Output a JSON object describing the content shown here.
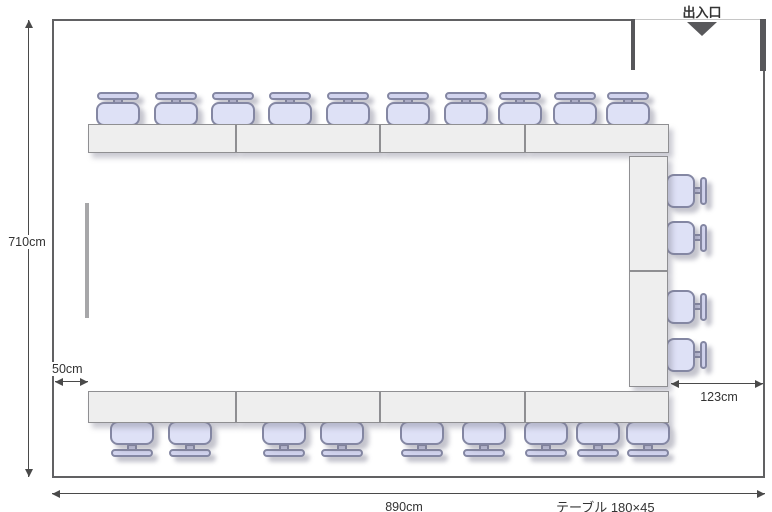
{
  "labels": {
    "entrance": "出入口",
    "room_height": "710cm",
    "room_width": "890cm",
    "left_gap": "50cm",
    "right_gap": "123cm",
    "table_spec": "テーブル 180×45"
  },
  "colors": {
    "wall": "#616163",
    "door_open_line": "#c6c6c6",
    "entrance_marker": "#58585b",
    "table_fill": "#eeeeee",
    "table_border": "#8f8f92",
    "chair_fill": "#dee1f6",
    "chair_back_fill": "#d2d4ee",
    "chair_border": "#8487a3",
    "dimension_line": "#4a4a4a",
    "text": "#333333"
  },
  "floorplan": {
    "room": {
      "x": 52,
      "y": 19,
      "w": 713,
      "h": 459
    },
    "whiteboard": {
      "x": 85,
      "y": 203,
      "w": 4,
      "h": 115
    },
    "tables": [
      {
        "x": 88,
        "y": 124,
        "w": 148,
        "h": 29
      },
      {
        "x": 236,
        "y": 124,
        "w": 144,
        "h": 29
      },
      {
        "x": 380,
        "y": 124,
        "w": 145,
        "h": 29
      },
      {
        "x": 525,
        "y": 124,
        "w": 144,
        "h": 29
      },
      {
        "x": 629,
        "y": 156,
        "w": 39,
        "h": 115
      },
      {
        "x": 629,
        "y": 271,
        "w": 39,
        "h": 116
      },
      {
        "x": 88,
        "y": 391,
        "w": 148,
        "h": 32
      },
      {
        "x": 236,
        "y": 391,
        "w": 144,
        "h": 32
      },
      {
        "x": 380,
        "y": 391,
        "w": 145,
        "h": 32
      },
      {
        "x": 525,
        "y": 391,
        "w": 144,
        "h": 32
      }
    ],
    "chairs": [
      {
        "side": "top",
        "cx": 118
      },
      {
        "side": "top",
        "cx": 176
      },
      {
        "side": "top",
        "cx": 233
      },
      {
        "side": "top",
        "cx": 290
      },
      {
        "side": "top",
        "cx": 348
      },
      {
        "side": "top",
        "cx": 408
      },
      {
        "side": "top",
        "cx": 466
      },
      {
        "side": "top",
        "cx": 520
      },
      {
        "side": "top",
        "cx": 575
      },
      {
        "side": "top",
        "cx": 628
      },
      {
        "side": "bottom",
        "cx": 132
      },
      {
        "side": "bottom",
        "cx": 190
      },
      {
        "side": "bottom",
        "cx": 284
      },
      {
        "side": "bottom",
        "cx": 342
      },
      {
        "side": "bottom",
        "cx": 422
      },
      {
        "side": "bottom",
        "cx": 484
      },
      {
        "side": "bottom",
        "cx": 546
      },
      {
        "side": "bottom",
        "cx": 598
      },
      {
        "side": "bottom",
        "cx": 648
      },
      {
        "side": "right",
        "cy": 191
      },
      {
        "side": "right",
        "cy": 238
      },
      {
        "side": "right",
        "cy": 307
      },
      {
        "side": "right",
        "cy": 355
      }
    ]
  }
}
